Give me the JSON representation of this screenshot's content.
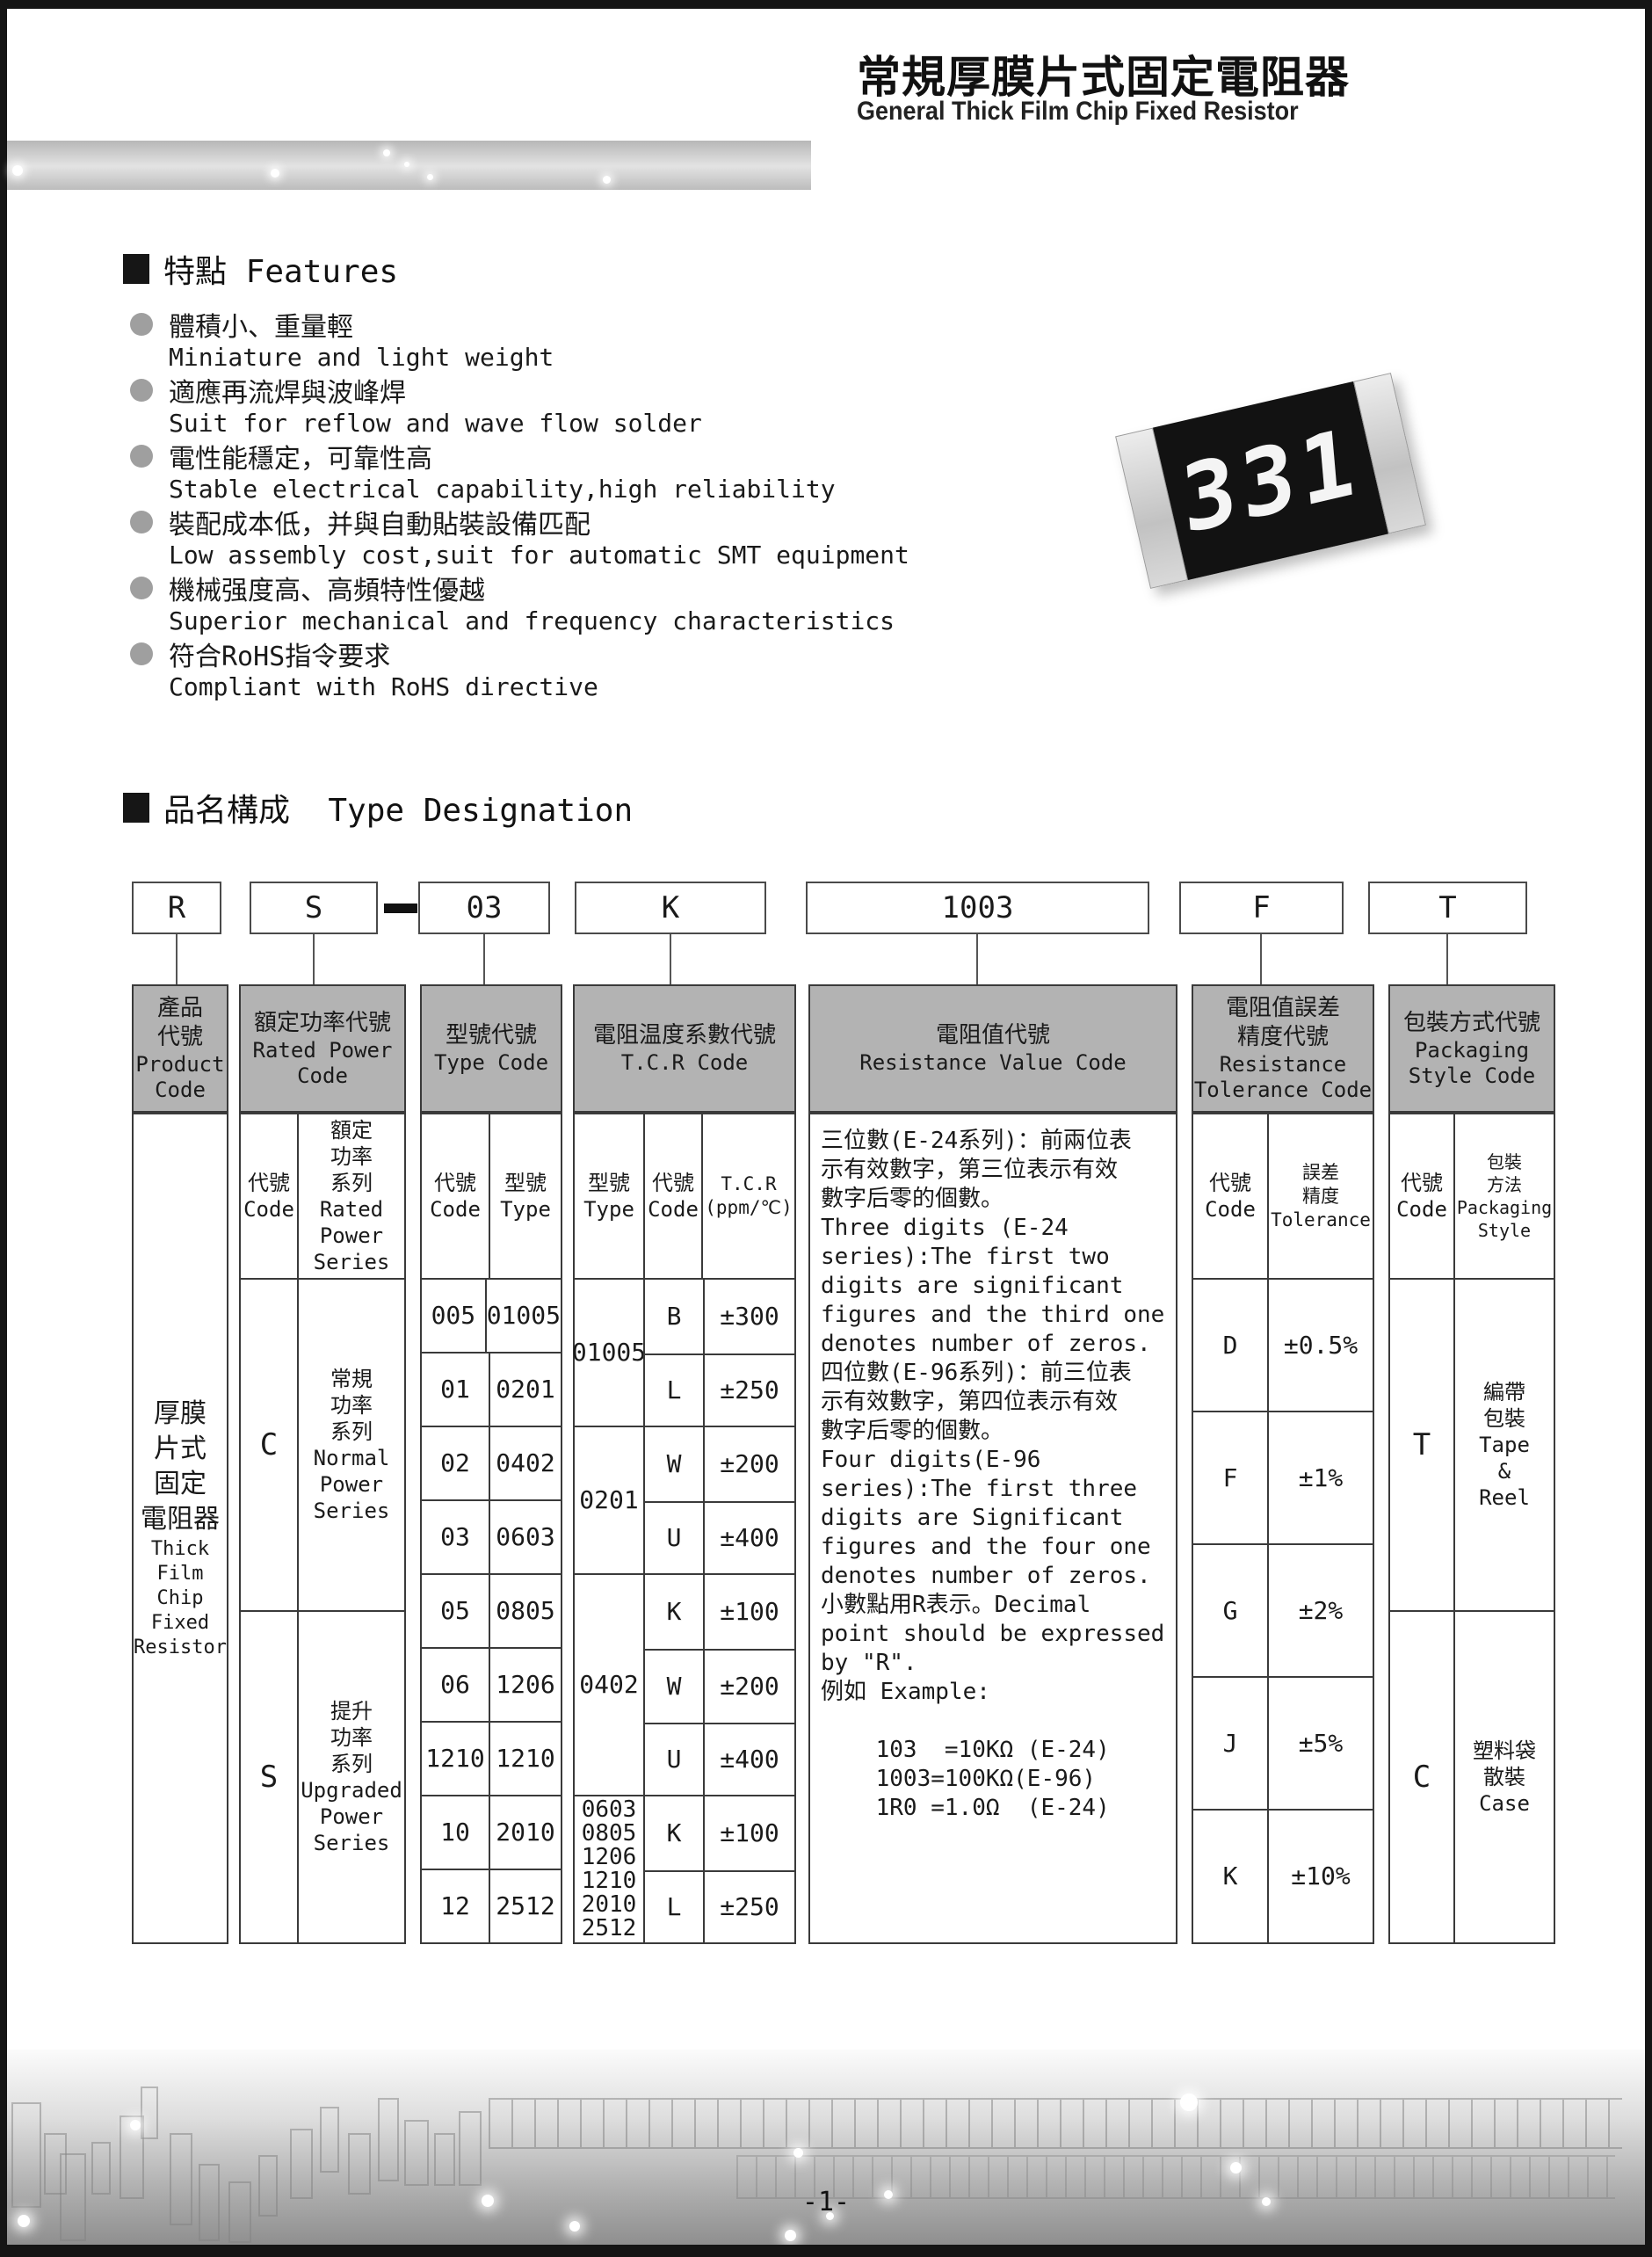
{
  "header": {
    "title_zh": "常規厚膜片式固定電阻器",
    "title_en": "General Thick Film Chip Fixed Resistor"
  },
  "colors": {
    "table_header_bg": "#b3b3b3",
    "band_gray": "#bcbcbc",
    "bullet_gray": "#9f9f9f",
    "resistor_body": "#121212"
  },
  "features": {
    "heading": "特點 Features",
    "items": [
      {
        "zh": "體積小、重量輕",
        "en": "Miniature and light weight"
      },
      {
        "zh": "適應再流焊與波峰焊",
        "en": "Suit for reflow and wave flow solder"
      },
      {
        "zh": "電性能穩定，可靠性高",
        "en": "Stable electrical capability,high reliability"
      },
      {
        "zh": "裝配成本低，并與自動貼裝設備匹配",
        "en": "Low assembly cost,suit for automatic SMT equipment"
      },
      {
        "zh": "機械强度高、高頻特性優越",
        "en": "Superior mechanical and frequency characteristics"
      },
      {
        "zh": "符合RoHS指令要求",
        "en": "Compliant with RoHS directive"
      }
    ]
  },
  "resistor": {
    "marking": "331"
  },
  "designation": {
    "heading": "品名構成  Type Designation",
    "codes": {
      "product": "R",
      "power": "S",
      "dash": "-",
      "type": "03",
      "tcr": "K",
      "value": "1003",
      "tolerance": "F",
      "packaging": "T"
    }
  },
  "table": {
    "product": {
      "header_zh": "產品\n代號",
      "header_en": "Product\nCode",
      "body_zh": "厚膜\n片式\n固定\n電阻器",
      "body_en": "Thick\nFilm\nChip\nFixed\nResistor"
    },
    "power": {
      "header_zh": "額定功率代號",
      "header_en": "Rated Power\nCode",
      "sub_code": "代號\nCode",
      "sub_series": "額定\n功率\n系列\nRated\nPower\nSeries",
      "rows": [
        {
          "code": "C",
          "series": "常規\n功率\n系列\nNormal\nPower\nSeries"
        },
        {
          "code": "S",
          "series": "提升\n功率\n系列\nUpgraded\nPower\nSeries"
        }
      ]
    },
    "type": {
      "header_zh": "型號代號",
      "header_en": "Type Code",
      "sub_code": "代號\nCode",
      "sub_type": "型號\nType",
      "rows": [
        [
          "005",
          "01005"
        ],
        [
          "01",
          "0201"
        ],
        [
          "02",
          "0402"
        ],
        [
          "03",
          "0603"
        ],
        [
          "05",
          "0805"
        ],
        [
          "06",
          "1206"
        ],
        [
          "1210",
          "1210"
        ],
        [
          "10",
          "2010"
        ],
        [
          "12",
          "2512"
        ]
      ]
    },
    "tcr": {
      "header_zh": "電阻温度系數代號",
      "header_en": "T.C.R Code",
      "sub_type": "型號\nType",
      "sub_code": "代號\nCode",
      "sub_tcr": "T.C.R\n(ppm/℃)",
      "groups": [
        {
          "type": "01005",
          "rows": [
            [
              "B",
              "±300"
            ],
            [
              "L",
              "±250"
            ]
          ]
        },
        {
          "type": "0201",
          "rows": [
            [
              "W",
              "±200"
            ],
            [
              "U",
              "±400"
            ]
          ]
        },
        {
          "type": "0402",
          "rows": [
            [
              "K",
              "±100"
            ],
            [
              "W",
              "±200"
            ],
            [
              "U",
              "±400"
            ]
          ]
        },
        {
          "type": "0603\n0805\n1206\n1210\n2010\n2512",
          "rows": [
            [
              "K",
              "±100"
            ],
            [
              "L",
              "±250"
            ]
          ]
        }
      ]
    },
    "value": {
      "header_zh": "電阻值代號",
      "header_en": "Resistance Value Code",
      "body": "三位數(E-24系列)：前兩位表\n示有效數字，第三位表示有效\n數字后零的個數。\nThree digits (E-24\nseries):The first two\ndigits are significant\nfigures and the third one\ndenotes number of zeros.\n四位數(E-96系列)：前三位表\n示有效數字，第四位表示有效\n數字后零的個數。\nFour digits(E-96\nseries):The first three\ndigits are Significant\nfigures and the four one\ndenotes number of zeros.\n小數點用R表示。Decimal\npoint should be expressed\nby \"R\".\n例如 Example:\n\n    103  =10KΩ (E-24)\n    1003=100KΩ(E-96)\n    1R0 =1.0Ω  (E-24)"
    },
    "tolerance": {
      "header_zh": "電阻值誤差\n精度代號",
      "header_en": "Resistance\nTolerance Code",
      "sub_code": "代號\nCode",
      "sub_tol": "誤差\n精度\nTolerance",
      "rows": [
        [
          "D",
          "±0.5%"
        ],
        [
          "F",
          "±1%"
        ],
        [
          "G",
          "±2%"
        ],
        [
          "J",
          "±5%"
        ],
        [
          "K",
          "±10%"
        ]
      ]
    },
    "packaging": {
      "header_zh": "包裝方式代號",
      "header_en": "Packaging\nStyle Code",
      "sub_code": "代號\nCode",
      "sub_style": "包裝\n方法\nPackaging\nStyle",
      "rows": [
        {
          "code": "T",
          "style": "編帶\n包裝\nTape\n&\nReel"
        },
        {
          "code": "C",
          "style": "塑料袋\n散裝\nCase"
        }
      ]
    }
  },
  "footer": {
    "page_number": "-1-"
  }
}
